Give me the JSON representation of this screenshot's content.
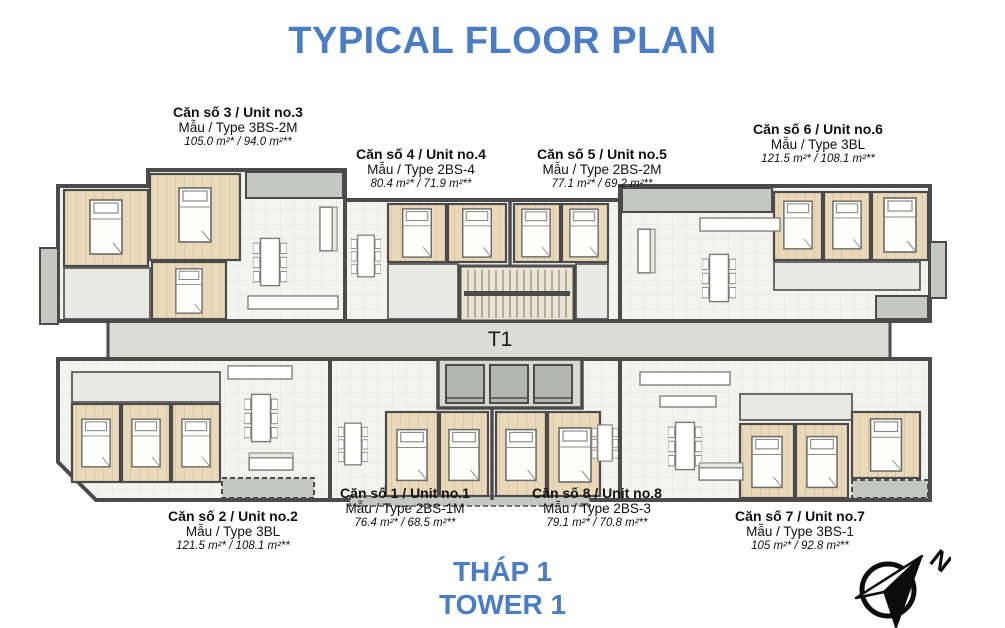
{
  "title": "TYPICAL FLOOR PLAN",
  "core_label": "T1",
  "tower": {
    "line1": "THÁP 1",
    "line2": "TOWER 1"
  },
  "compass_label": "N",
  "colors": {
    "accent_blue": "#4a7dc5",
    "wall": "#4b4b4b",
    "bedroom_floor": "#e9d8b9",
    "living_floor": "#f3f3f0",
    "balcony": "#c5c7c2",
    "corridor": "#dcded5"
  },
  "units": [
    {
      "no": "3",
      "name": "Căn số 3 / Unit no.3",
      "type": "Mẫu / Type 3BS-2M",
      "area": "105.0 m²* / 94.0 m²**"
    },
    {
      "no": "4",
      "name": "Căn số 4 / Unit no.4",
      "type": "Mẫu / Type 2BS-4",
      "area": "80.4 m²* / 71.9 m²**"
    },
    {
      "no": "5",
      "name": "Căn số 5 / Unit no.5",
      "type": "Mẫu / Type 2BS-2M",
      "area": "77.1 m²* / 69.2 m²**"
    },
    {
      "no": "6",
      "name": "Căn số 6 / Unit no.6",
      "type": "Mẫu / Type 3BL",
      "area": "121.5 m²* / 108.1 m²**"
    },
    {
      "no": "2",
      "name": "Căn số 2 / Unit no.2",
      "type": "Mẫu / Type 3BL",
      "area": "121.5 m²* / 108.1 m²**"
    },
    {
      "no": "1",
      "name": "Căn số 1 / Unit no.1",
      "type": "Mẫu / Type 2BS-1M",
      "area": "76.4 m²* / 68.5 m²**"
    },
    {
      "no": "8",
      "name": "Căn số 8 / Unit no.8",
      "type": "Mẫu / Type 2BS-3",
      "area": "79.1 m²* / 70.8 m²**"
    },
    {
      "no": "7",
      "name": "Căn số 7 / Unit no.7",
      "type": "Mẫu / Type 3BS-1",
      "area": "105 m²* / 92.8 m²**"
    }
  ]
}
